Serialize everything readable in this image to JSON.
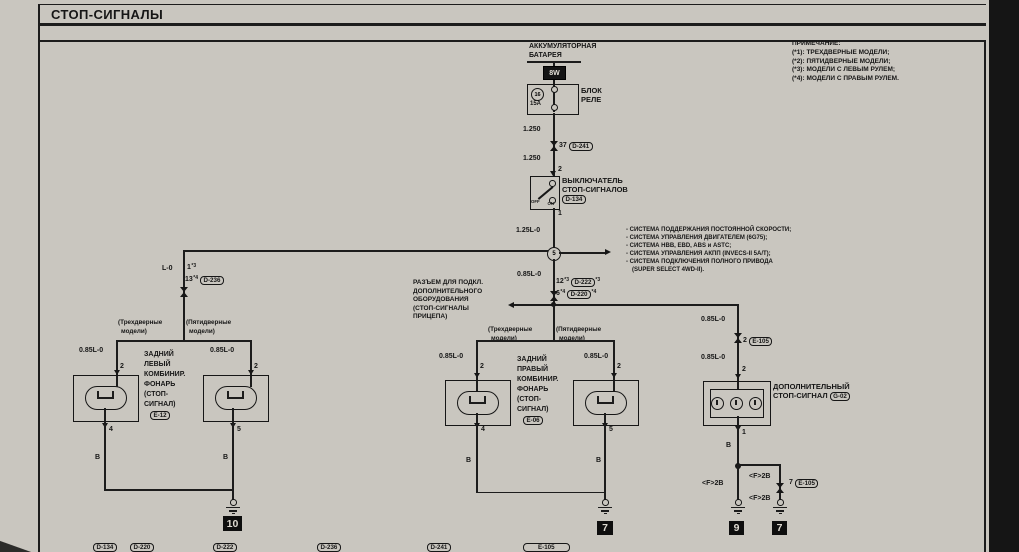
{
  "colors": {
    "page_bg": "#c9c6bf",
    "ink": "#1c1c1c",
    "scan_strip": "#151515"
  },
  "title": "СТОП-СИГНАЛЫ",
  "notes": {
    "header": "ПРИМЕЧАНИЕ:",
    "items": [
      "(*1): ТРЕХДВЕРНЫЕ МОДЕЛИ;",
      "(*2): ПЯТИДВЕРНЫЕ МОДЕЛИ;",
      "(*3): МОДЕЛИ С ЛЕВЫМ РУЛЕМ;",
      "(*4): МОДЕЛИ С ПРАВЫМ РУЛЕМ."
    ]
  },
  "battery": {
    "name1": "АККУМУЛЯТОРНАЯ",
    "name2": "БАТАРЕЯ",
    "wire": "8W"
  },
  "relay": {
    "name1": "БЛОК",
    "name2": "РЕЛЕ",
    "fuse_no": "16",
    "fuse_rating": "15A",
    "wire_above": "1.250",
    "pin": "37",
    "conn": "D-241",
    "wire_below": "1.250"
  },
  "stop_switch": {
    "pin_in": "2",
    "name1": "ВЫКЛЮЧАТЕЛЬ",
    "name2": "СТОП-СИГНАЛОВ",
    "conn": "D-134",
    "off": "OFF",
    "on": "ON",
    "pin_out": "1",
    "wire_out": "1.25L-0"
  },
  "junction": {
    "no": "5",
    "wire_below": "0.85L-0",
    "pin_a": "12",
    "sup_a": "*3",
    "conn_a": "D-222",
    "sup_a2": "*3",
    "pin_b": "6",
    "sup_b": "*4",
    "conn_b": "D-220",
    "sup_b2": "*4"
  },
  "systems": [
    "- СИСТЕМА ПОДДЕРЖАНИЯ ПОСТОЯННОЙ СКОРОСТИ;",
    "- СИСТЕМА УПРАВЛЕНИЯ ДВИГАТЕЛЕМ (6G75);",
    "- СИСТЕМА HBB, EBD, ABS и ASTC;",
    "- СИСТЕМА УПРАВЛЕНИЯ АКПП (INVECS-II 5A/T);",
    "- СИСТЕМА ПОДКЛЮЧЕНИЯ ПОЛНОГО ПРИВОДА",
    "(SUPER SELECT 4WD-II)."
  ],
  "left_branch": {
    "wire": "L-0",
    "pin_a": "1",
    "sup_a": "*3",
    "pin_b": "13",
    "sup_b": "*4",
    "conn": "D-236"
  },
  "models": {
    "three_a": "(Трехдверные",
    "three_b": "модели)",
    "five_a": "(Пятидверные",
    "five_b": "модели)"
  },
  "left_lamps": {
    "wire": "0.85L-0",
    "pin_top": "2",
    "name": [
      "ЗАДНИЙ",
      "ЛЕВЫЙ",
      "КОМБИНИР.",
      "ФОНАРЬ",
      "(СТОП-",
      "СИГНАЛ)"
    ],
    "conn": "E-12",
    "pin_bot_a": "4",
    "pin_bot_b": "5",
    "wire_gnd": "B",
    "gnd_ref": "10"
  },
  "right_lamps": {
    "wire": "0.85L-0",
    "pin_top": "2",
    "name": [
      "ЗАДНИЙ",
      "ПРАВЫЙ",
      "КОМБИНИР.",
      "ФОНАРЬ",
      "(СТОП-",
      "СИГНАЛ)"
    ],
    "conn": "E-06",
    "pin_bot_a": "4",
    "pin_bot_b": "5",
    "wire_gnd": "B",
    "gnd_ref": "7"
  },
  "trailer": {
    "lines": [
      "РАЗЪЕМ ДЛЯ ПОДКЛ.",
      "ДОПОЛНИТЕЛЬНОГО",
      "ОБОРУДОВАНИЯ",
      "(СТОП-СИГНАЛЫ",
      "ПРИЦЕПА)"
    ]
  },
  "aux_stop": {
    "wire": "0.85L-0",
    "pin_conn_a": "2",
    "conn_a": "E-105",
    "pin_in": "2",
    "name1": "ДОПОЛНИТЕЛЬНЫЙ",
    "name2": "СТОП-СИГНАЛ",
    "conn": "G-02",
    "pin_out": "1",
    "wire_gnd": "B",
    "flat_wire": "<F>2B",
    "pin_conn_b": "7",
    "conn_b": "E-105",
    "gnd_ref_a": "9",
    "gnd_ref_b": "7"
  },
  "bottom_refs": [
    "D-134",
    "D-220",
    "D-222",
    "D-236",
    "D-241",
    "E-105"
  ]
}
